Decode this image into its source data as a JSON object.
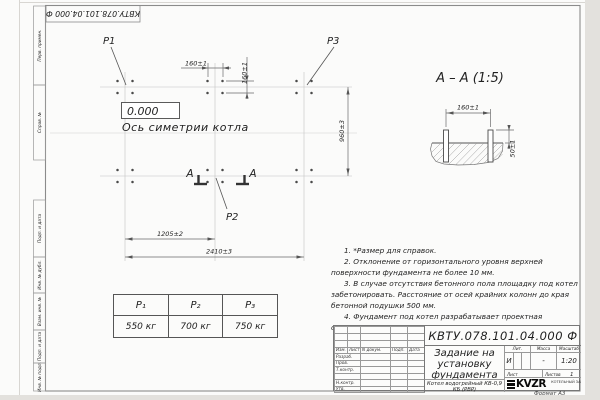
{
  "sheet": {
    "designation": "КВТУ.078.101.04.000 Ф",
    "format_label": "Формат А3"
  },
  "frame_strip": {
    "items": [
      "Перв. примен.",
      "Справ. №",
      "Подп. и дата",
      "Инв. № дубл.",
      "Взам. инв. №",
      "Подп. и дата",
      "Инв. № подл."
    ]
  },
  "plan": {
    "p1": "P1",
    "p2": "P2",
    "p3": "P3",
    "elevation": "0.000",
    "axis_label": "Ось симетрии котла",
    "dim_160h": "160±1",
    "dim_160v": "160±1",
    "dim_960": "960±3",
    "dim_1205": "1205±2",
    "dim_2410": "2410±3",
    "section_mark": "А"
  },
  "section": {
    "title": "А – А (1:5)",
    "dim_160": "160±1",
    "dim_50": "50±1"
  },
  "loads_table": {
    "headers": [
      "P₁",
      "P₂",
      "P₃"
    ],
    "values": [
      "550 кг",
      "700 кг",
      "750 кг"
    ]
  },
  "notes": [
    "1. *Размер для справок.",
    "2. Отклонение от горизонтального уровня верхней поверхности фундамента не более 10 мм.",
    "3. В случае отсутствия бетонного пола площадку под котел забетонировать. Расстояние от осей крайних колонн до края бетонной подушки 500 мм.",
    "4. Фундамент под котел разрабатывает проектная организация по нагрузкам на фундамент."
  ],
  "title_block": {
    "doc_title": "Задание на установку фундамента",
    "product": "Котел водогрейный КВ-0,9 КБ (РВР)",
    "header_cols": [
      "Изм.",
      "Лист",
      "N докум.",
      "Подп.",
      "Дата"
    ],
    "rows": [
      "Разраб.",
      "Пров.",
      "Т.контр.",
      "Н.контр.",
      "Утв."
    ],
    "lit_label": "Лит.",
    "mass_label": "Масса",
    "scale_label": "Масштаб",
    "lit_value": "И",
    "mass_value": "-",
    "scale_value": "1:20",
    "sheet_label": "Лист",
    "sheets_label": "Листов",
    "sheets_value": "1",
    "logo_text": "KVZR",
    "logo_caption": "КОТЕЛЬНЫЙ ЗАВОД РЭП"
  }
}
